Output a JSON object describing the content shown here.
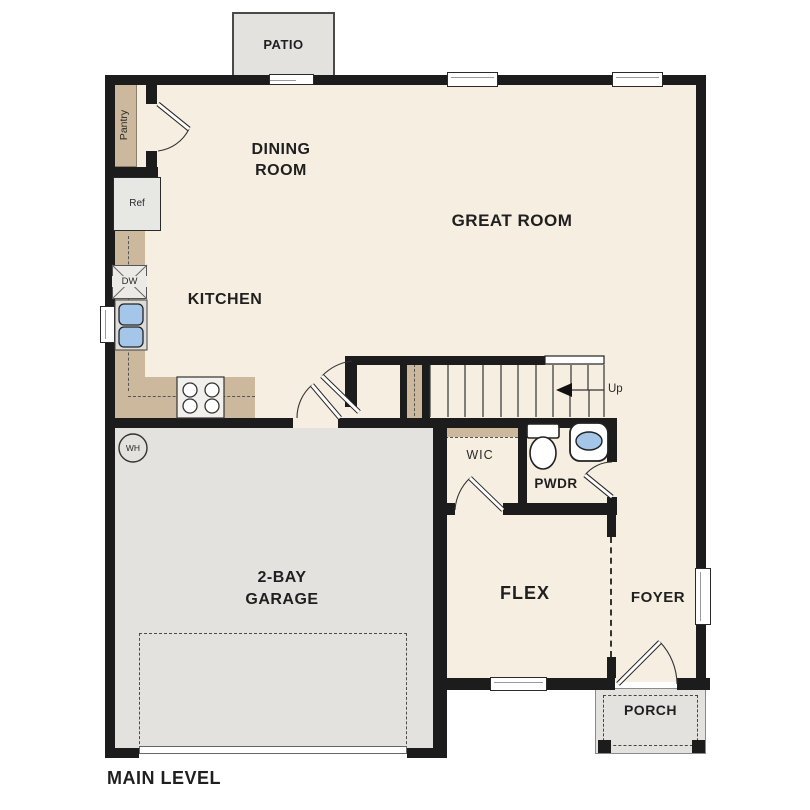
{
  "title": "MAIN LEVEL",
  "rooms": {
    "patio": {
      "label": "PATIO"
    },
    "dining_room": {
      "line1": "DINING",
      "line2": "ROOM"
    },
    "great_room": {
      "label": "GREAT ROOM"
    },
    "kitchen": {
      "label": "KITCHEN"
    },
    "garage": {
      "line1": "2-BAY",
      "line2": "GARAGE"
    },
    "flex": {
      "label": "FLEX"
    },
    "foyer": {
      "label": "FOYER"
    },
    "porch": {
      "label": "PORCH"
    },
    "wic": {
      "label": "WIC"
    },
    "powder": {
      "label": "PWDR"
    }
  },
  "appliances": {
    "pantry": "Pantry",
    "refrigerator": "Ref",
    "dishwasher": "DW",
    "water_heater": "WH"
  },
  "stairs": {
    "up_label": "Up"
  },
  "colors": {
    "floor": "#f6eee1",
    "garage_floor": "#e3e2df",
    "counter_tan": "#cbb89d",
    "wall": "#1c1c1c",
    "fixture_blue": "#a4c6e8"
  }
}
